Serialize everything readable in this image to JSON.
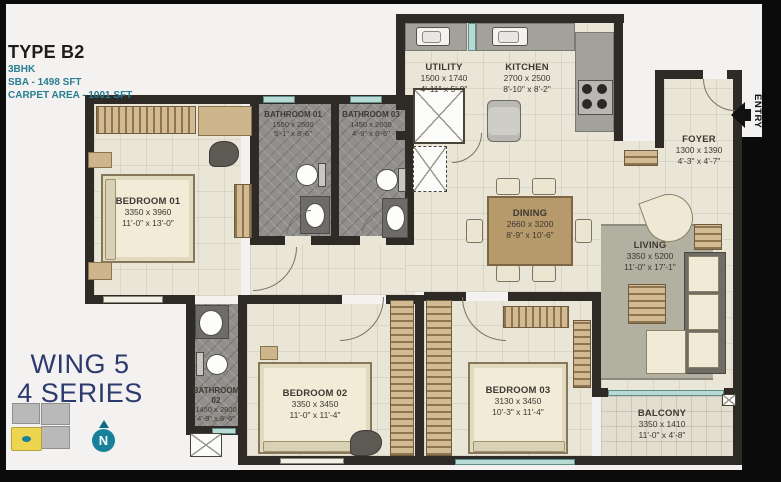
{
  "header": {
    "type": "TYPE B2",
    "config": "3BHK",
    "sba": "SBA - 1498 SFT",
    "carpet": "CARPET AREA - 1001 SFT"
  },
  "wing": {
    "line1": "WING 5",
    "line2": "4 SERIES"
  },
  "entry": {
    "label": "ENTRY"
  },
  "compass": {
    "letter": "N"
  },
  "rooms": [
    {
      "id": "bedroom-01",
      "name": "BEDROOM 01",
      "dim_mm": "3350 x 3960",
      "dim_ft": "11'-0\" x 13'-0\""
    },
    {
      "id": "bathroom-01",
      "name": "BATHROOM 01",
      "dim_mm": "1550 x 2600",
      "dim_ft": "5'-1\" x 8'-6\""
    },
    {
      "id": "bathroom-03",
      "name": "BATHROOM 03",
      "dim_mm": "1450 x 2600",
      "dim_ft": "4'-9\" x 8'-6\""
    },
    {
      "id": "utility",
      "name": "UTILITY",
      "dim_mm": "1500 x 1740",
      "dim_ft": "4'-11\" x 5'-9\""
    },
    {
      "id": "kitchen",
      "name": "KITCHEN",
      "dim_mm": "2700 x 2500",
      "dim_ft": "8'-10\" x 8'-2\""
    },
    {
      "id": "foyer",
      "name": "FOYER",
      "dim_mm": "1300 x 1390",
      "dim_ft": "4'-3\" x 4'-7\""
    },
    {
      "id": "dining",
      "name": "DINING",
      "dim_mm": "2660 x 3200",
      "dim_ft": "8'-9\" x 10'-6\""
    },
    {
      "id": "living",
      "name": "LIVING",
      "dim_mm": "3350 x 5200",
      "dim_ft": "11'-0\" x 17'-1\""
    },
    {
      "id": "bathroom-02",
      "name": "BATHROOM 02",
      "dim_mm": "1450 x 2800",
      "dim_ft": "4'-9\" x 8'-6\""
    },
    {
      "id": "bedroom-02",
      "name": "BEDROOM 02",
      "dim_mm": "3350 x 3450",
      "dim_ft": "11'-0\" x 11'-4\""
    },
    {
      "id": "bedroom-03",
      "name": "BEDROOM 03",
      "dim_mm": "3130 x 3450",
      "dim_ft": "10'-3\" x 11'-4\""
    },
    {
      "id": "balcony",
      "name": "BALCONY",
      "dim_mm": "3350 x 1410",
      "dim_ft": "11'-0\" x 4'-8\""
    }
  ],
  "colors": {
    "accent_teal": "#2a7e92",
    "navy": "#2c3a6e",
    "wall": "#2e2a26",
    "floor_cream": "#eae6d7",
    "bath_tile": "#918f8c",
    "window_glass": "#b7dad4",
    "keyplan_highlight": "#ecd64f",
    "compass_teal": "#17809b"
  }
}
